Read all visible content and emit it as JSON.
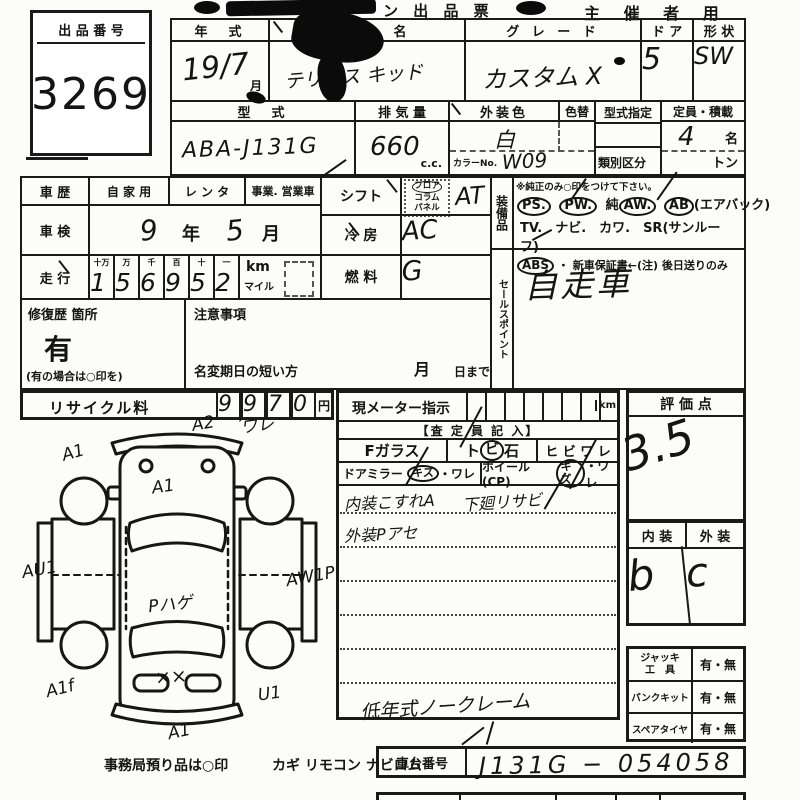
{
  "title": {
    "fragment": "ン 出 品 票",
    "organizer": "主 催 者 用"
  },
  "lot": {
    "label": "出 品 番 号",
    "number": "3269"
  },
  "head": {
    "year_label": "年　式",
    "year": "19/7",
    "month_suffix": "月",
    "name_label": "名",
    "name": "テリオス キッド",
    "grade_label": "グ レ ー ド",
    "grade": "カスタム X",
    "door_label": "ド ア",
    "door": "5",
    "shape_label": "形 状",
    "shape": "SW",
    "model_label": "型　式",
    "model": "ABA-J131G",
    "disp_label": "排 気 量",
    "disp": "660",
    "disp_unit": "c.c.",
    "color_label": "外装色",
    "color": "白",
    "color_change_label": "色替",
    "color_no_label": "カラーNo.",
    "color_no": "W09",
    "type_desig_label": "型式指定",
    "class_label": "類別区分",
    "capacity_label": "定員・積載",
    "capacity": "4",
    "capacity_unit": "名",
    "ton_label": "トン"
  },
  "history": {
    "label": "車 歴",
    "opt1": "自 家 用",
    "opt2": "レ ン タ",
    "opt3": "事業. 営業車",
    "inspection_label": "車 検",
    "inspection_year": "9",
    "year_char": "年",
    "inspection_month": "5",
    "month_char": "月",
    "mileage_label": "走 行",
    "u0": "十万",
    "u1": "万",
    "u2": "千",
    "u3": "百",
    "u4": "十",
    "u5": "一",
    "d0": "1",
    "d1": "5",
    "d2": "6",
    "d3": "9",
    "d4": "5",
    "d5": "2",
    "km_label": "km",
    "mile_label": "マイル"
  },
  "repair": {
    "label": "修復歴 箇所",
    "value": "有",
    "note": "(有の場合は○印を)"
  },
  "caution": {
    "label": "注意事項",
    "name_change": "名変期日の短い方",
    "month": "月",
    "due": "日まで"
  },
  "controls": {
    "shift_label": "シフト",
    "shift_opt1": "フロア",
    "shift_opt2": "コラム",
    "shift_opt3": "パネル",
    "shift_value": "AT",
    "ac_label": "冷 房",
    "ac_value": "AC",
    "fuel_label": "燃 料",
    "fuel_value": "G"
  },
  "equipment": {
    "label": "装備品",
    "note": "※純正のみ○印をつけて下さい。",
    "ps": "PS.",
    "pw": "PW.",
    "jun": "純",
    "aw": "AW.",
    "ab": "AB",
    "ab_paren": "(エアバック)",
    "line2": "TV.　ナビ.　カワ.　SR(サンルーフ)",
    "abs": "ABS",
    "line3_rest": "・ 新車保証書←(注) 後日送りのみ"
  },
  "sales": {
    "label": "セールスポイント",
    "value": "自走車"
  },
  "recycle": {
    "label": "リサイクル料",
    "d0": "9",
    "comma": ",",
    "d1": "9",
    "d2": "7",
    "d3": "0",
    "unit": "円"
  },
  "diagram": {
    "top_a": "A2",
    "top_b": "ワレ",
    "front_left": "A1",
    "hood": "A1",
    "left": "AU1",
    "roof": "Pハゲ",
    "right": "AW1P",
    "rear_left": "A1f",
    "rear": "××",
    "rear_right": "U1",
    "bottom": "A1"
  },
  "meter": {
    "label": "現メーター指示",
    "unit": "km"
  },
  "assess": {
    "header": "【査 定 員 記 入】",
    "fglass": "Fガラス",
    "stone_pre": "ト",
    "stone_circled": "ビ",
    "stone_post": "石",
    "crack": "ヒ ビ ワ レ",
    "mirror_label": "ドアミラー",
    "mirror_kizu": "キズ",
    "mirror_ware": "・ワレ",
    "wheel_label": "ホイール(CP)",
    "wheel_kizu": "キズ",
    "wheel_ware": "・ワレ",
    "note1a": "内装こすれA",
    "note1b": "下廻リサビ",
    "note2": "外装Pアセ",
    "note_last": "低年式ノークレーム"
  },
  "evaluation": {
    "label": "評 価 点",
    "score": "3.5",
    "interior_label": "内 装",
    "exterior_label": "外 装",
    "interior": "b",
    "exterior": "c"
  },
  "accessories": {
    "jack_label1": "ジャッキ",
    "jack_label2": "工　具",
    "jack_value": "有・無",
    "punk_label": "パンクキット",
    "punk_value": "有・無",
    "spare_label": "スペアタイヤ",
    "spare_value": "有・無"
  },
  "chassis": {
    "label": "車台番号",
    "value": "J131G − 054058"
  },
  "office": {
    "label": "事務局預り品は○印",
    "items": "カギ  リモコン  ナビロム"
  }
}
